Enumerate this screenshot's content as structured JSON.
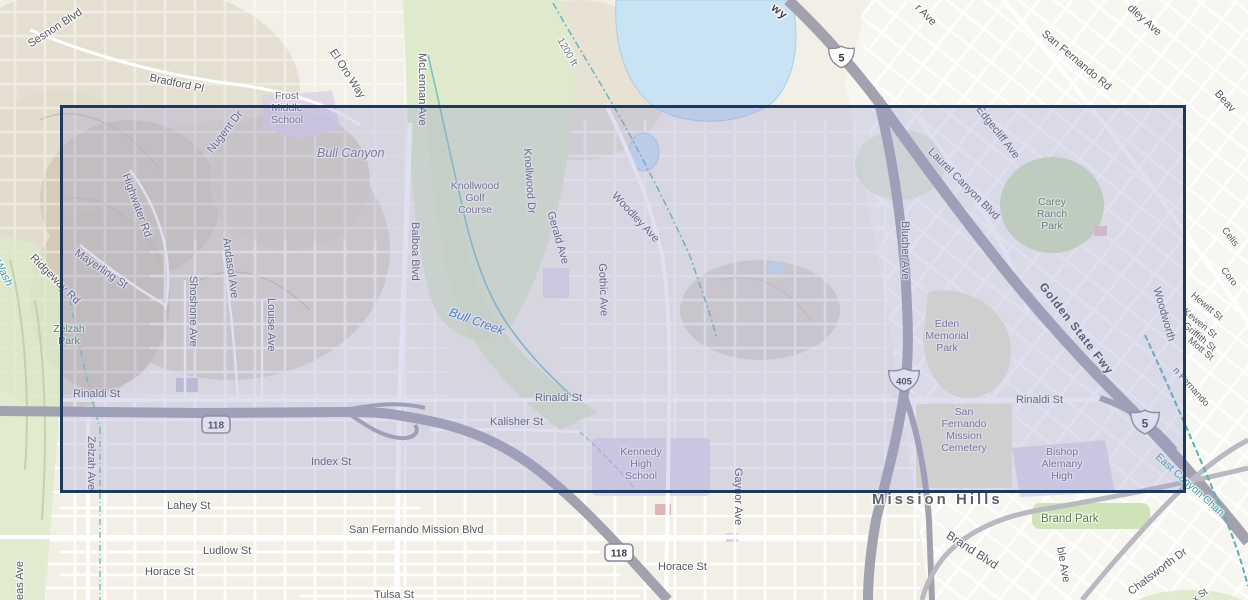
{
  "map": {
    "kind": "topographic-basemap-with-selection-extent",
    "labels": {
      "sesnon_blvd": "Sesnon Blvd",
      "bradford_pl": "Bradford Pl",
      "frost_middle_school": "Frost\nMiddle\nSchool",
      "nugent_dr": "Nugent Dr",
      "el_oro_way": "El Oro Way",
      "mclennan_ave": "McLennan Ave",
      "bull_canyon": "Bull Canyon",
      "elevation_1200ft": "1200 ft",
      "fwy_partial": "wy",
      "ave_partial_top": "r Ave",
      "san_fernando_rd": "San Fernando Rd",
      "dley_ave_partial": "dley Ave",
      "beaver_partial": "Beav",
      "edgecliff_ave": "Edgecliff Ave",
      "laurel_canyon_blvd": "Laurel Canyon Blvd",
      "carey_ranch_park": "Carey\nRanch\nPark",
      "blucher_ave": "Blucher Ave",
      "golden_state_fwy": "Golden State Fwy",
      "eden_memorial_park": "Eden\nMemorial\nPark",
      "woodworth": "Woodworth",
      "celis": "Celis",
      "coro_partial": "Coro",
      "hewitt_st": "Hewitt St",
      "kewen_st": "Kewen St",
      "griffith_st": "Griffith St",
      "mott_st": "Mott St",
      "san_fernando_partial": "n Fernando",
      "east_canyon_channel": "East Canyon Chan",
      "wash": "Wash",
      "ridgeway_rd": "Ridgeway Rd",
      "highwater_rd": "Highwater Rd",
      "mayerling_st": "Mayerling St",
      "zelzah_park": "Zelzah\nPark",
      "shoshone_ave": "Shoshone Ave",
      "andasol_ave": "Andasol Ave",
      "louise_ave": "Louise Ave",
      "balboa_blvd": "Balboa Blvd",
      "knollwood_golf_course": "Knollwood\nGolf\nCourse",
      "knollwood_dr": "Knollwood Dr",
      "gerald_ave": "Gerald Ave",
      "gothic_ave": "Gothic Ave",
      "woodley_ave": "Woodley Ave",
      "bull_creek": "Bull Creek",
      "rinaldi_st": "Rinaldi St",
      "kalisher_st": "Kalisher St",
      "index_st": "Index St",
      "zelzah_ave": "Zelzah Ave",
      "eas_ave_partial": "eas Ave",
      "lahey_st": "Lahey St",
      "ludlow_st": "Ludlow St",
      "horace_st": "Horace St",
      "san_fernando_mission_blvd": "San Fernando Mission Blvd",
      "tulsa_st": "Tulsa St",
      "kennedy_high_school": "Kennedy\nHigh\nSchool",
      "gaynor_ave": "Gaynor Ave",
      "mission_hills": "Mission Hills",
      "san_fernando_mission_cemetery": "San\nFernando\nMission\nCemetery",
      "bishop_alemany_high": "Bishop\nAlemany\nHigh",
      "brand_park": "Brand Park",
      "brand_blvd": "Brand Blvd",
      "ble_ave_partial": "ble Ave",
      "chatsworth_dr": "Chatsworth Dr",
      "x_st_partial": "x St"
    },
    "shields": {
      "interstate_5": "5",
      "interstate_405": "405",
      "ca_118": "118"
    },
    "colors": {
      "land": "#f2f0e6",
      "selection_fill": "#9798d2",
      "selection_border": "#1c3a5e",
      "water": "#c9e3f5",
      "park_green": "#d5e6bd",
      "school_purple": "#ddd4e8",
      "cemetery_yellow": "#e9e6cd",
      "freeway_gray": "#a2a2af",
      "road_label_gray": "#565661",
      "water_label_blue": "#3679b8",
      "channel_teal": "#3d9aa5"
    }
  }
}
